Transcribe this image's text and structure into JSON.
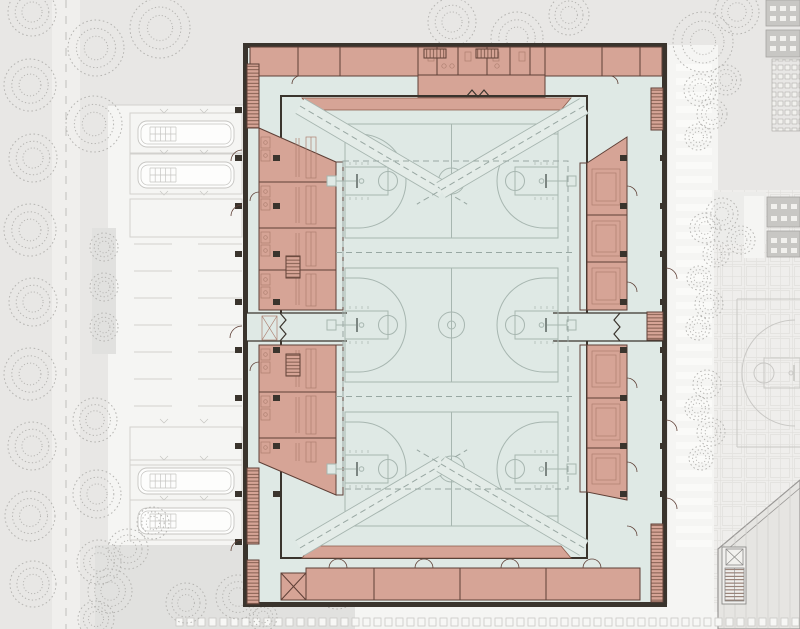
{
  "image": {
    "kind": "architectural site and floor plan",
    "subject": "triple sports hall with three indoor basketball courts, changing blocks, bus and car parking, paved plaza with outdoor hoop",
    "visible_text": ""
  },
  "colors": {
    "site_bg": "#e8e7e5",
    "zone_light": "#f5f5f3",
    "road": "#f0efed",
    "lawn": "#e1e1df",
    "plaza": "#efeeec",
    "plaza_grid": "#dddcd9",
    "plaza_grid2": "#e4e3e0",
    "tree": "#b5b4b1",
    "stall_line": "#d2d1ce",
    "vehicle_line": "#c6c5c2",
    "paver_fill": "#f7f7f5",
    "paver_line": "#c9c8c5",
    "walkway_bar": "#fafaf8",
    "road_dash": "#c8c7c5",
    "wall": "#3a342d",
    "hall_floor": "#dfe9e5",
    "court_line": "#a7b6b0",
    "curtain_dash": "#98a7a2",
    "band_fill": "#e4ece8",
    "room_fill": "#d6a496",
    "room_wall": "#5f4037",
    "room_line": "#ad7f70",
    "tribune_line": "#8a5a4a",
    "wall_bars": "#96705f",
    "hatch": "#6d4a3c",
    "backboard": "#6a7570",
    "outdoor_line": "#c9c8c5",
    "neighbor_fill": "#e6e5e2",
    "neighbor_line": "#9a9896",
    "neighbor_hatch": "#d2d1ce",
    "dark_block": "#c8c7c4",
    "dark_block_line": "#a5a4a1",
    "window": "#f2f1ee"
  },
  "site": {
    "parking": {
      "bus_bays": 6,
      "buses": 4,
      "car_stall_columns": 2,
      "car_stall_lines_per_column": 7
    },
    "road_marking": "dashed-centerline",
    "walkway_steps": 35,
    "paver_band_squares": 57,
    "outdoor_basketball_hoops": 1,
    "neighbor_buildings": 3
  },
  "building": {
    "sports_hall": {
      "indoor_basketball_courts": 3,
      "hoops": 6,
      "divider_curtain_lines": 2,
      "telescopic_tribunes": 2,
      "wall_bar_strips": 4,
      "corner_braces": 4
    },
    "changing_blocks_west": 2,
    "equipment_blocks_east": 2,
    "storage_rooms_south": 4,
    "entrance_lobby_north": 1,
    "stairs": 8,
    "x_marked_shafts": 3
  },
  "geometry": {
    "courts": {
      "cys": [
        181,
        325,
        469
      ]
    },
    "curtain": {
      "rect": [
        343,
        161,
        225,
        328
      ],
      "hlines": [
        252.5,
        396.5
      ],
      "hx": [
        336,
        574
      ]
    },
    "bands": [
      [
        300,
        106,
        443,
        190
      ],
      [
        584,
        106,
        441,
        190
      ],
      [
        300,
        548,
        443,
        464
      ],
      [
        584,
        548,
        441,
        464
      ]
    ],
    "walkway_bars": {
      "x": 676,
      "w": 36,
      "h": 7,
      "y0": 64,
      "step": 14,
      "count": 35
    },
    "pavers": {
      "x0": 176,
      "y": 618,
      "w": 7,
      "h": 8,
      "step": 11,
      "count": 57
    },
    "stalls": {
      "cols": [
        [
          134,
          172
        ],
        [
          198,
          242
        ]
      ],
      "y0": 244,
      "step": 27,
      "count": 7
    },
    "buses": {
      "x": 130,
      "bus_ys": [
        119,
        160,
        466,
        506
      ],
      "empty_ys": [
        199,
        427
      ]
    },
    "columns": {
      "ys": [
        110,
        158,
        206,
        254,
        302,
        350,
        398,
        446,
        494,
        542
      ],
      "outer_left_x": 235,
      "inner_left_x": 273,
      "inner_right_x": 620,
      "outer_right_x": 660,
      "block_ranges": [
        [
          133,
          312
        ],
        [
          343,
          500
        ]
      ]
    },
    "bottom_doors_xs": [
      338,
      424,
      510,
      592
    ],
    "rooms_left": [
      [
        133,
        182
      ],
      [
        182,
        228
      ],
      [
        228,
        270
      ],
      [
        270,
        310
      ],
      [
        345,
        392
      ],
      [
        392,
        438
      ],
      [
        438,
        466
      ]
    ],
    "rooms_right": [
      [
        163,
        215
      ],
      [
        215,
        262
      ],
      [
        262,
        310
      ],
      [
        345,
        398
      ],
      [
        398,
        448
      ],
      [
        448,
        490
      ]
    ],
    "stairs": [
      [
        247,
        64,
        12,
        64
      ],
      [
        247,
        468,
        12,
        76
      ],
      [
        247,
        560,
        12,
        44
      ],
      [
        651,
        88,
        12,
        42
      ],
      [
        647,
        312,
        16,
        28
      ],
      [
        651,
        524,
        12,
        78
      ],
      [
        424,
        49,
        22,
        9
      ],
      [
        476,
        49,
        22,
        9
      ],
      [
        286,
        256,
        14,
        22
      ],
      [
        286,
        354,
        14,
        22
      ]
    ],
    "roof_lines": {
      "x0": 724,
      "step": 11,
      "count": 7,
      "y1": 466,
      "y2": 628
    },
    "trees": [
      [
        32,
        12,
        24
      ],
      [
        30,
        85,
        26
      ],
      [
        33,
        158,
        24
      ],
      [
        30,
        230,
        26
      ],
      [
        33,
        302,
        24
      ],
      [
        30,
        374,
        26
      ],
      [
        32,
        446,
        24
      ],
      [
        30,
        516,
        25
      ],
      [
        33,
        584,
        23
      ],
      [
        96,
        48,
        28
      ],
      [
        94,
        124,
        28
      ],
      [
        104,
        247,
        14
      ],
      [
        104,
        287,
        14
      ],
      [
        104,
        327,
        14
      ],
      [
        95,
        420,
        22
      ],
      [
        97,
        494,
        24
      ],
      [
        99,
        562,
        22
      ],
      [
        96,
        619,
        18
      ],
      [
        160,
        28,
        30
      ],
      [
        452,
        22,
        24
      ],
      [
        517,
        38,
        26
      ],
      [
        569,
        15,
        20
      ],
      [
        703,
        42,
        30
      ],
      [
        737,
        12,
        22
      ],
      [
        700,
        90,
        16
      ],
      [
        712,
        114,
        15
      ],
      [
        698,
        137,
        13
      ],
      [
        726,
        80,
        15
      ],
      [
        722,
        214,
        16
      ],
      [
        741,
        240,
        14
      ],
      [
        705,
        228,
        15
      ],
      [
        716,
        254,
        13
      ],
      [
        699,
        278,
        12
      ],
      [
        709,
        304,
        14
      ],
      [
        698,
        328,
        12
      ],
      [
        707,
        384,
        14
      ],
      [
        697,
        408,
        12
      ],
      [
        711,
        432,
        14
      ],
      [
        701,
        458,
        12
      ],
      [
        128,
        549,
        20
      ],
      [
        110,
        591,
        22
      ],
      [
        153,
        523,
        16
      ],
      [
        186,
        603,
        20
      ],
      [
        238,
        597,
        22
      ],
      [
        301,
        571,
        16
      ],
      [
        337,
        587,
        22
      ],
      [
        263,
        617,
        14
      ]
    ]
  }
}
